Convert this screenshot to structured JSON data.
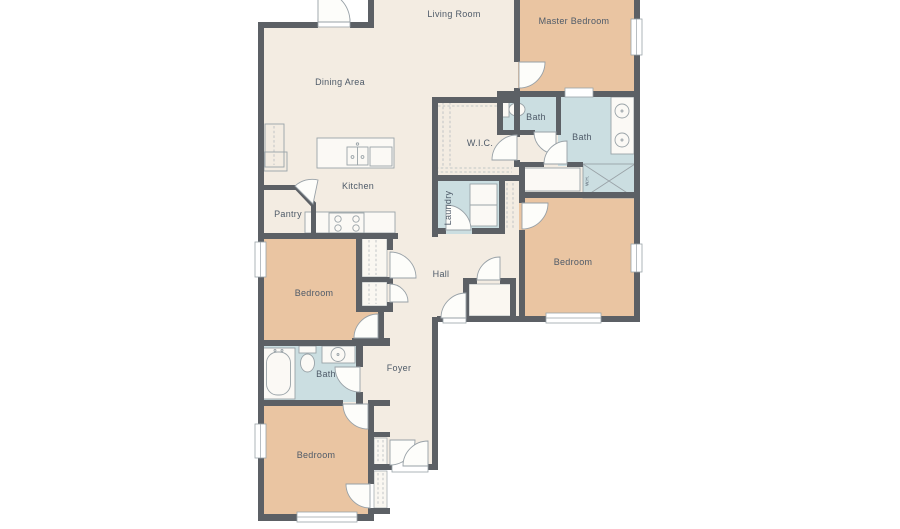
{
  "colors": {
    "background": "#ffffff",
    "floor": "#f3ece2",
    "bedroom": "#eac5a2",
    "bath": "#cbdee1",
    "wall": "#5c6065",
    "fixture_stroke": "#9aa3a8",
    "door_stroke": "#98a1a7",
    "label": "#4e5a68"
  },
  "rooms": [
    {
      "id": "living-room",
      "label": "Living Room"
    },
    {
      "id": "master-bedroom",
      "label": "Master Bedroom"
    },
    {
      "id": "dining-area",
      "label": "Dining Area"
    },
    {
      "id": "bath-toilet",
      "label": "Bath"
    },
    {
      "id": "bath-master",
      "label": "Bath"
    },
    {
      "id": "wic",
      "label": "W.I.C."
    },
    {
      "id": "kitchen",
      "label": "Kitchen"
    },
    {
      "id": "pantry",
      "label": "Pantry"
    },
    {
      "id": "laundry",
      "label": "Laundry"
    },
    {
      "id": "bedroom-right",
      "label": "Bedroom"
    },
    {
      "id": "hall",
      "label": "Hall"
    },
    {
      "id": "bedroom-left",
      "label": "Bedroom"
    },
    {
      "id": "bath-hall",
      "label": "Bath"
    },
    {
      "id": "foyer",
      "label": "Foyer"
    },
    {
      "id": "bedroom-bottom",
      "label": "Bedroom"
    },
    {
      "id": "water-heater",
      "label": "W.H."
    }
  ]
}
